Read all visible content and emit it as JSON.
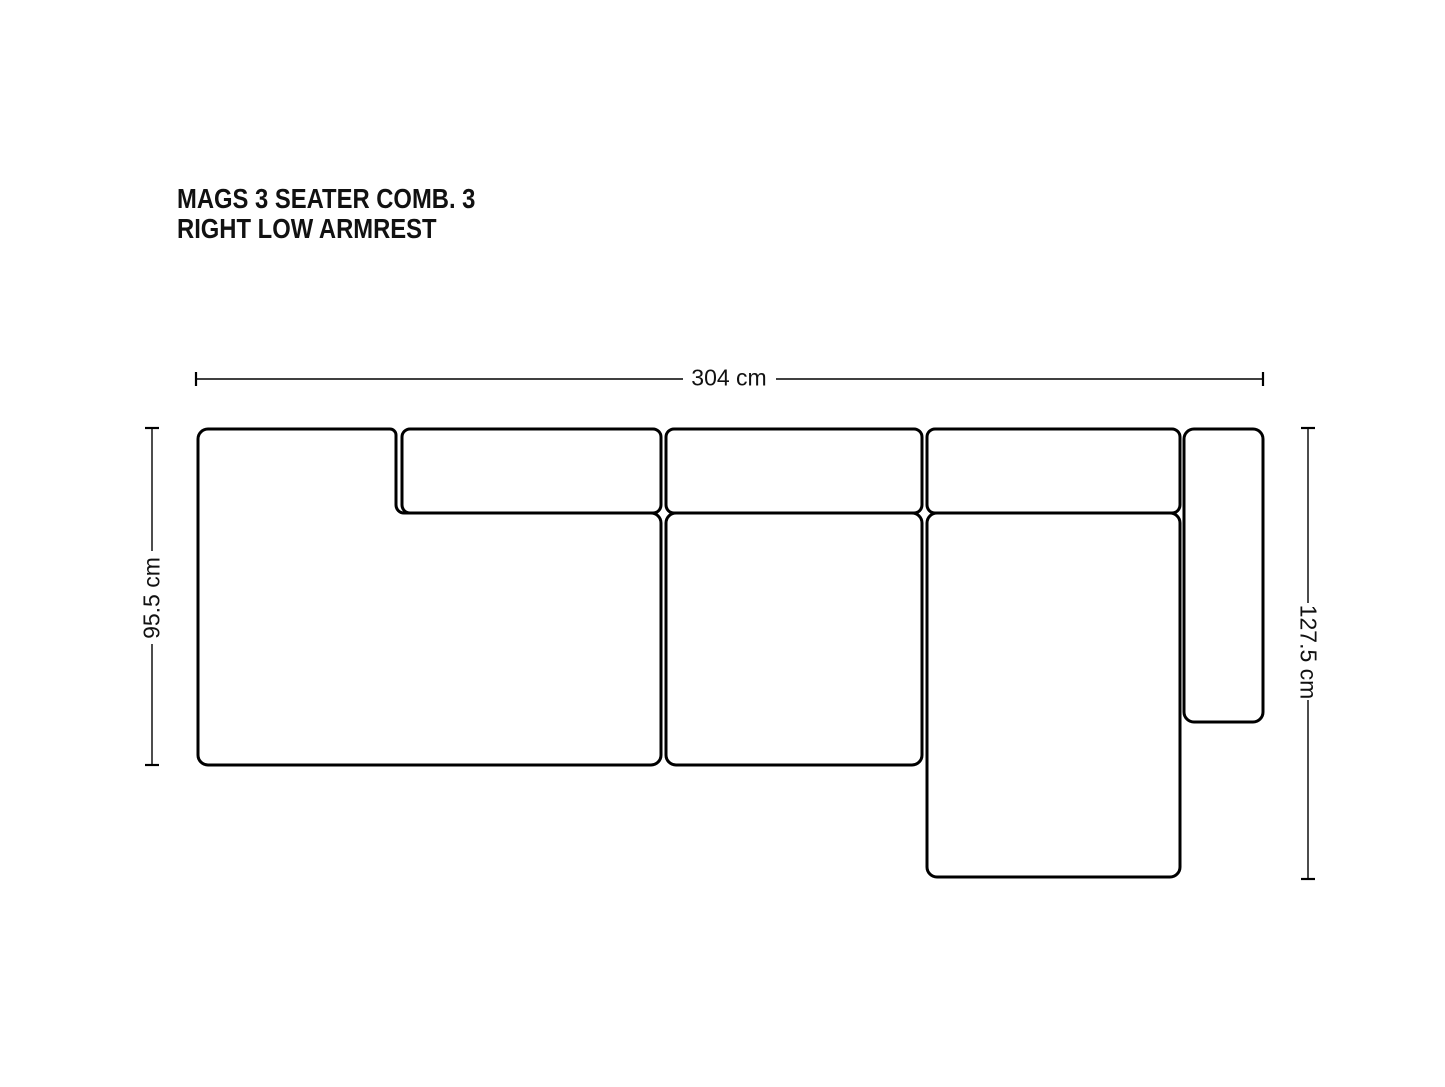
{
  "title": {
    "line1": "MAGS 3 SEATER COMB. 3",
    "line2": "RIGHT LOW ARMREST"
  },
  "dimensions": {
    "width_label": "304 cm",
    "left_depth_label": "95.5 cm",
    "right_depth_label": "127.5 cm"
  },
  "colors": {
    "line": "#000000",
    "text": "#111111",
    "background": "#ffffff"
  }
}
